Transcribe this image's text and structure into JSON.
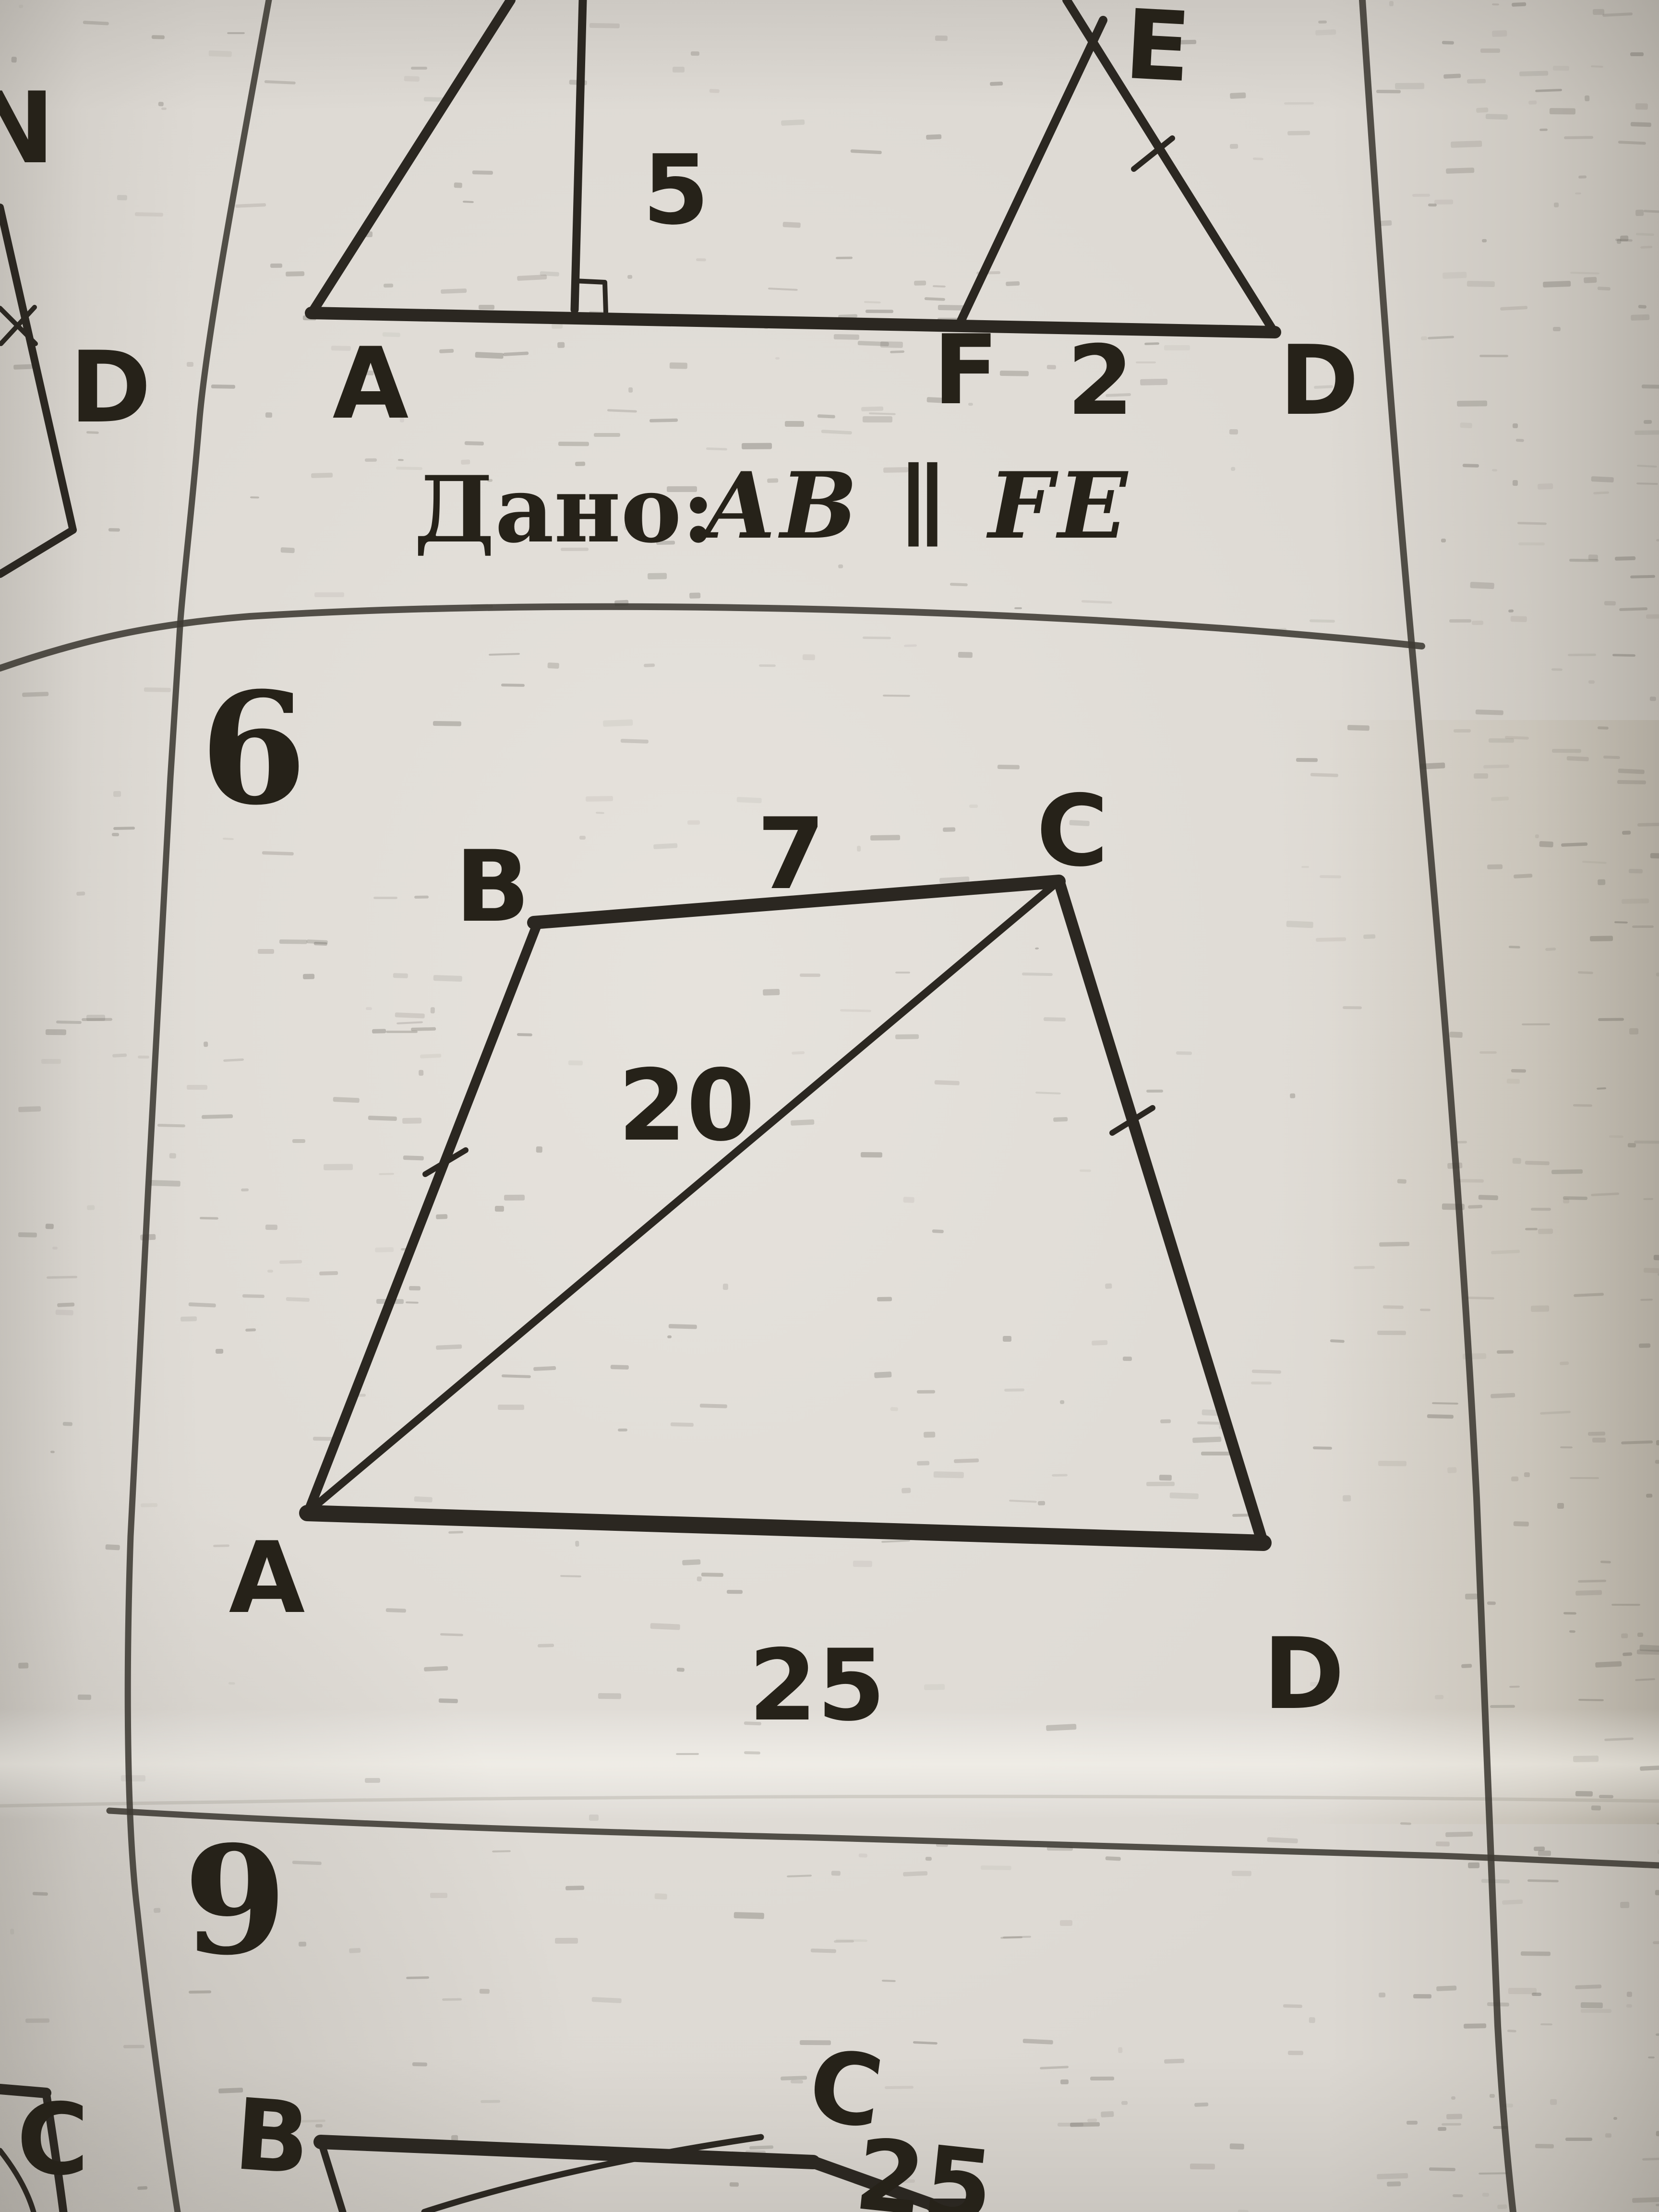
{
  "colors": {
    "paper": "#dcd8d2",
    "ink": "#2b2721",
    "grid": "#3e3a33",
    "label": "#262219"
  },
  "top_left_cell": {
    "label_n": "N",
    "label_d": "D"
  },
  "figure5": {
    "label_a": "A",
    "height_value": "5",
    "label_e": "E",
    "label_f": "F",
    "segment_fd_value": "2",
    "label_d": "D",
    "given_prefix": "Дано:",
    "given_formula": "AB ∥ FE"
  },
  "problem6": {
    "number": "6",
    "label_b": "B",
    "side_bc_value": "7",
    "label_c": "C",
    "diagonal_ac_value": "20",
    "label_a": "A",
    "side_ad_value": "25",
    "label_d": "D"
  },
  "problem9": {
    "number": "9",
    "left_cell_label_c": "C",
    "label_b": "B",
    "label_c": "C",
    "value_25": "25"
  }
}
